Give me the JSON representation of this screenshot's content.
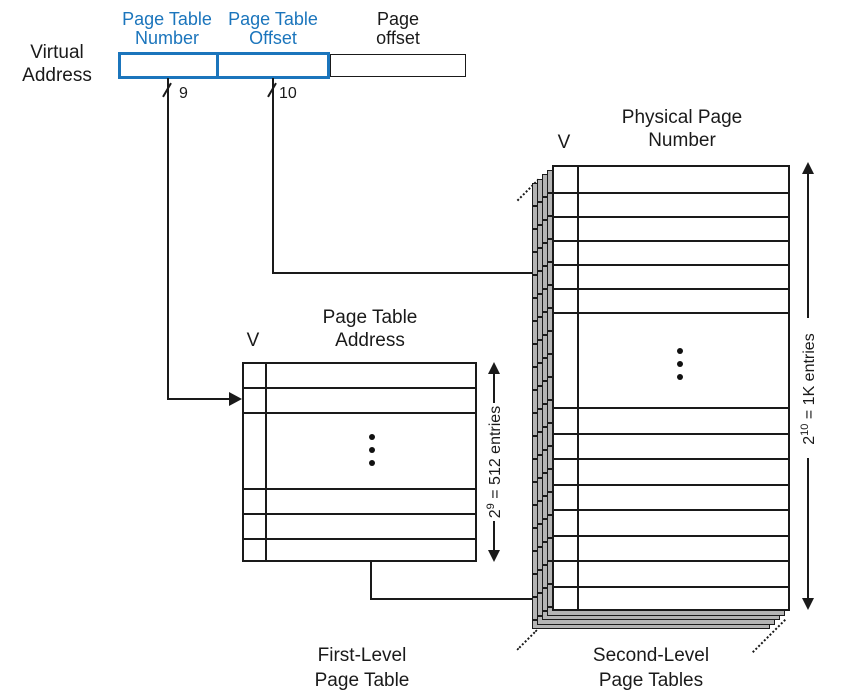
{
  "colors": {
    "field_accent": "#1b75bc",
    "stack_gray": "#b4b4b4",
    "line": "#1a1a1a"
  },
  "virtual_address": {
    "label_line1": "Virtual",
    "label_line2": "Address",
    "fields": [
      {
        "label_line1": "Page Table",
        "label_line2": "Number",
        "bits": "9"
      },
      {
        "label_line1": "Page Table",
        "label_line2": "Offset",
        "bits": "10"
      },
      {
        "label_line1": "Page",
        "label_line2": "offset"
      }
    ]
  },
  "first_level_table": {
    "v_header": "V",
    "header_line1": "Page Table",
    "header_line2": "Address",
    "caption_line1": "First-Level",
    "caption_line2": "Page Table",
    "annotation": {
      "base": "2",
      "exponent": "9",
      "rest": " = 512 entries"
    }
  },
  "second_level_table": {
    "v_header": "V",
    "header_line1": "Physical Page",
    "header_line2": "Number",
    "caption_line1": "Second-Level",
    "caption_line2": "Page Tables",
    "annotation": {
      "base": "2",
      "exponent": "10",
      "rest": " = 1K entries"
    }
  }
}
